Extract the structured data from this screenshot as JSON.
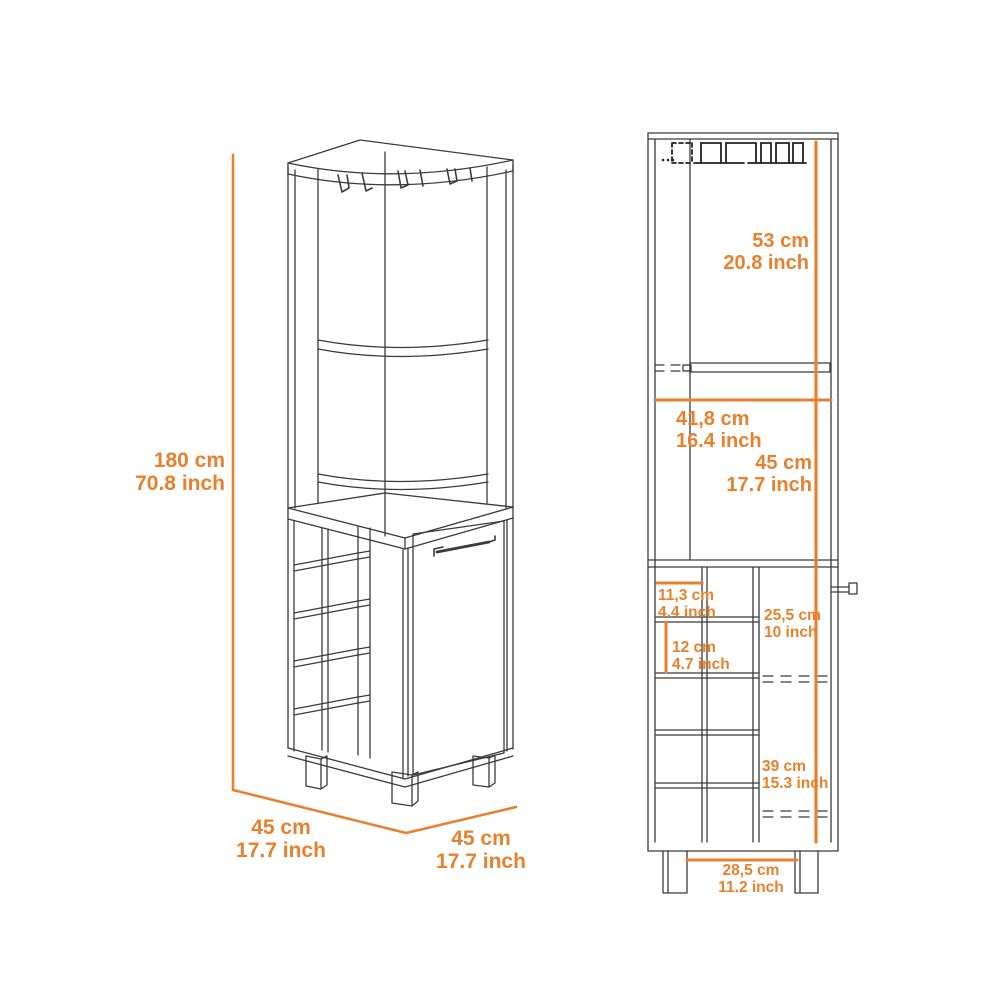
{
  "title": "corner-bar-cabinet-dimension-diagram",
  "colors": {
    "background": "#FFFFFF",
    "dimension_accent": "#E8802D",
    "drawing_line": "#3B3B3B"
  },
  "perspective_view": {
    "height": {
      "cm": "180 cm",
      "inch": "70.8 inch"
    },
    "depth": {
      "cm": "45 cm",
      "inch": "17.7 inch"
    },
    "width": {
      "cm": "45 cm",
      "inch": "17.7 inch"
    }
  },
  "front_view": {
    "upper_cavity_height": {
      "cm": "53 cm",
      "inch": "20.8 inch"
    },
    "interior_width": {
      "cm": "41,8 cm",
      "inch": "16.4 inch"
    },
    "lower_cavity_height": {
      "cm": "45 cm",
      "inch": "17.7 inch"
    },
    "bottle_cubby_width": {
      "cm": "11,3 cm",
      "inch": "4.4 inch"
    },
    "bottle_cubby_height": {
      "cm": "12 cm",
      "inch": "4.7 inch"
    },
    "door_upper_section_height": {
      "cm": "25,5 cm",
      "inch": "10 inch"
    },
    "door_lower_section_height": {
      "cm": "39 cm",
      "inch": "15.3 inch"
    },
    "leg_spacing": {
      "cm": "28,5 cm",
      "inch": "11.2 inch"
    }
  }
}
